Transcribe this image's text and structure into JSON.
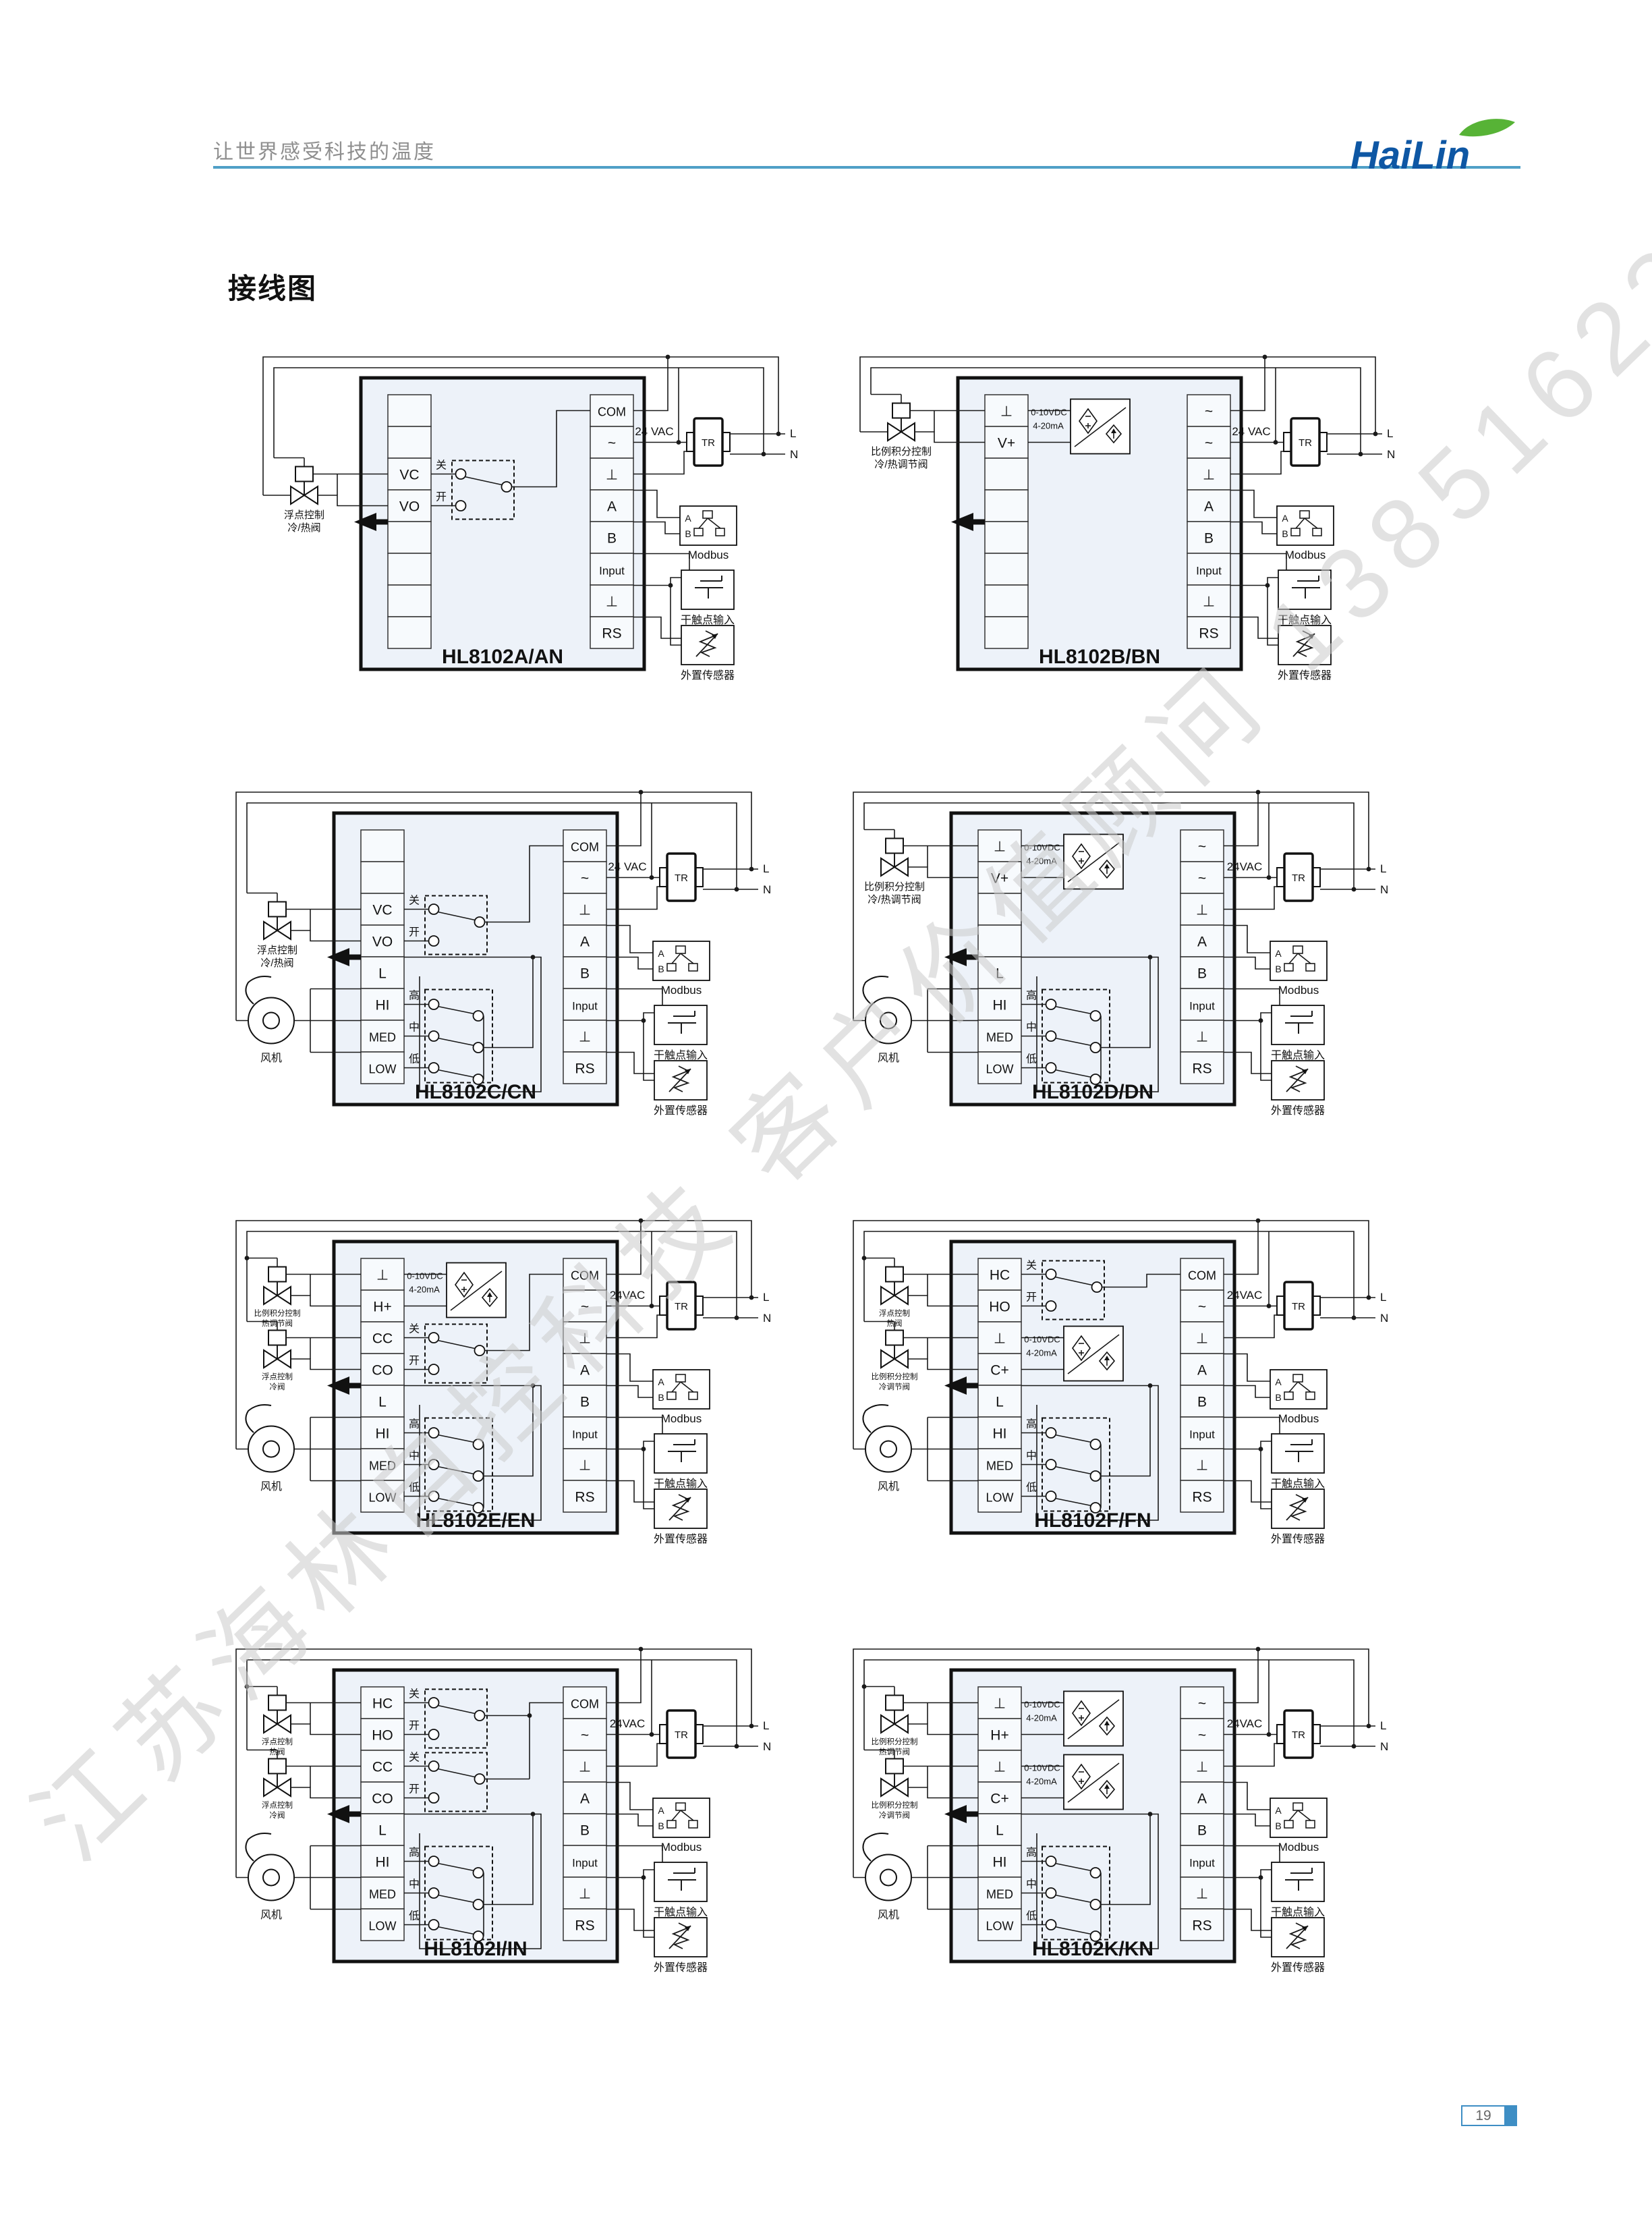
{
  "header": {
    "tagline": "让世界感受科技的温度",
    "logo_text": "HaiLin"
  },
  "section_title": "接线图",
  "watermark": {
    "text": "江苏海林自控科技 客户价值顾问 13851623601"
  },
  "footer": {
    "page_number": "19"
  },
  "colors": {
    "rule_blue": "#4f9fc7",
    "accent_blue": "#3e8ec4",
    "logo_blue": "#0e57a4",
    "leaf_green": "#57b336",
    "unit_fill": "#edf2f9",
    "cell_fill": "#f7fafd",
    "line": "#1a1a1a",
    "watermark_gray": "#cccccc",
    "tagline_gray": "#8f8f8f"
  },
  "strings": {
    "tr": "TR",
    "line_live": "L",
    "line_neutral": "N",
    "modbus": "Modbus",
    "modbus_a": "A",
    "modbus_b": "B",
    "dry_contact": "干触点输入",
    "ext_sensor": "外置传感器",
    "fan": "风机",
    "conv_line1": "0-10VDC",
    "conv_line2": "4-20mA",
    "switch_close": "关",
    "switch_open": "开",
    "speed_high": "高",
    "speed_mid": "中",
    "speed_low": "低"
  },
  "diagrams": [
    {
      "id": "A",
      "title": "HL8102A/AN",
      "vac": "24 VAC",
      "left": [
        "",
        "",
        "VC",
        "VO",
        "",
        "",
        "",
        ""
      ],
      "right": [
        "COM",
        "~",
        "⊥",
        "A",
        "B",
        "Input",
        "⊥",
        "RS"
      ],
      "valves": [
        {
          "rows": [
            2,
            3
          ],
          "label": [
            "浮点控制",
            "冷/热阀"
          ]
        }
      ],
      "switches2": [
        {
          "rows": [
            2,
            3
          ]
        }
      ],
      "converters": [],
      "gang3": false,
      "fan": false
    },
    {
      "id": "B",
      "title": "HL8102B/BN",
      "vac": "24 VAC",
      "left": [
        "⊥",
        "V+",
        "",
        "",
        "",
        "",
        "",
        ""
      ],
      "right": [
        "~",
        "~",
        "⊥",
        "A",
        "B",
        "Input",
        "⊥",
        "RS"
      ],
      "valves": [
        {
          "rows": [
            0,
            1
          ],
          "label": [
            "比例积分控制",
            "冷/热调节阀"
          ]
        }
      ],
      "switches2": [],
      "converters": [
        {
          "rows": [
            0,
            1
          ]
        }
      ],
      "gang3": false,
      "fan": false
    },
    {
      "id": "C",
      "title": "HL8102C/CN",
      "vac": "24 VAC",
      "left": [
        "",
        "",
        "VC",
        "VO",
        "L",
        "HI",
        "MED",
        "LOW"
      ],
      "right": [
        "COM",
        "~",
        "⊥",
        "A",
        "B",
        "Input",
        "⊥",
        "RS"
      ],
      "valves": [
        {
          "rows": [
            2,
            3
          ],
          "label": [
            "浮点控制",
            "冷/热阀"
          ]
        }
      ],
      "switches2": [
        {
          "rows": [
            2,
            3
          ]
        }
      ],
      "converters": [],
      "gang3": true,
      "fan": true
    },
    {
      "id": "D",
      "title": "HL8102D/DN",
      "vac": "24VAC",
      "left": [
        "⊥",
        "V+",
        "",
        "",
        "L",
        "HI",
        "MED",
        "LOW"
      ],
      "right": [
        "~",
        "~",
        "⊥",
        "A",
        "B",
        "Input",
        "⊥",
        "RS"
      ],
      "valves": [
        {
          "rows": [
            0,
            1
          ],
          "label": [
            "比例积分控制",
            "冷/热调节阀"
          ]
        }
      ],
      "switches2": [],
      "converters": [
        {
          "rows": [
            0,
            1
          ]
        }
      ],
      "gang3": true,
      "fan": true
    },
    {
      "id": "E",
      "title": "HL8102E/EN",
      "vac": "24VAC",
      "left": [
        "⊥",
        "H+",
        "CC",
        "CO",
        "L",
        "HI",
        "MED",
        "LOW"
      ],
      "right": [
        "COM",
        "~",
        "⊥",
        "A",
        "B",
        "Input",
        "⊥",
        "RS"
      ],
      "valves": [
        {
          "rows": [
            0,
            1
          ],
          "label": [
            "比例积分控制",
            "热调节阀"
          ],
          "small": true
        },
        {
          "rows": [
            2,
            3
          ],
          "label": [
            "浮点控制",
            "冷阀"
          ],
          "small": true
        }
      ],
      "switches2": [
        {
          "rows": [
            2,
            3
          ]
        }
      ],
      "converters": [
        {
          "rows": [
            0,
            1
          ]
        }
      ],
      "gang3": true,
      "fan": true
    },
    {
      "id": "F",
      "title": "HL8102F/FN",
      "vac": "24VAC",
      "left": [
        "HC",
        "HO",
        "⊥",
        "C+",
        "L",
        "HI",
        "MED",
        "LOW"
      ],
      "right": [
        "COM",
        "~",
        "⊥",
        "A",
        "B",
        "Input",
        "⊥",
        "RS"
      ],
      "valves": [
        {
          "rows": [
            0,
            1
          ],
          "label": [
            "浮点控制",
            "热阀"
          ],
          "small": true
        },
        {
          "rows": [
            2,
            3
          ],
          "label": [
            "比例积分控制",
            "冷调节阀"
          ],
          "small": true
        }
      ],
      "switches2": [
        {
          "rows": [
            0,
            1
          ]
        }
      ],
      "converters": [
        {
          "rows": [
            2,
            3
          ]
        }
      ],
      "gang3": true,
      "fan": true
    },
    {
      "id": "I",
      "title": "HL8102I/IN",
      "vac": "24VAC",
      "left": [
        "HC",
        "HO",
        "CC",
        "CO",
        "L",
        "HI",
        "MED",
        "LOW"
      ],
      "right": [
        "COM",
        "~",
        "⊥",
        "A",
        "B",
        "Input",
        "⊥",
        "RS"
      ],
      "valves": [
        {
          "rows": [
            0,
            1
          ],
          "label": [
            "浮点控制",
            "热阀"
          ],
          "small": true
        },
        {
          "rows": [
            2,
            3
          ],
          "label": [
            "浮点控制",
            "冷阀"
          ],
          "small": true
        }
      ],
      "switches2": [
        {
          "rows": [
            0,
            1
          ]
        },
        {
          "rows": [
            2,
            3
          ]
        }
      ],
      "converters": [],
      "gang3": true,
      "fan": true
    },
    {
      "id": "K",
      "title": "HL8102K/KN",
      "vac": "24VAC",
      "left": [
        "⊥",
        "H+",
        "⊥",
        "C+",
        "L",
        "HI",
        "MED",
        "LOW"
      ],
      "right": [
        "~",
        "~",
        "⊥",
        "A",
        "B",
        "Input",
        "⊥",
        "RS"
      ],
      "valves": [
        {
          "rows": [
            0,
            1
          ],
          "label": [
            "比例积分控制",
            "热调节阀"
          ],
          "small": true
        },
        {
          "rows": [
            2,
            3
          ],
          "label": [
            "比例积分控制",
            "冷调节阀"
          ],
          "small": true
        }
      ],
      "switches2": [],
      "converters": [
        {
          "rows": [
            0,
            1
          ]
        },
        {
          "rows": [
            2,
            3
          ]
        }
      ],
      "gang3": true,
      "fan": true
    }
  ]
}
